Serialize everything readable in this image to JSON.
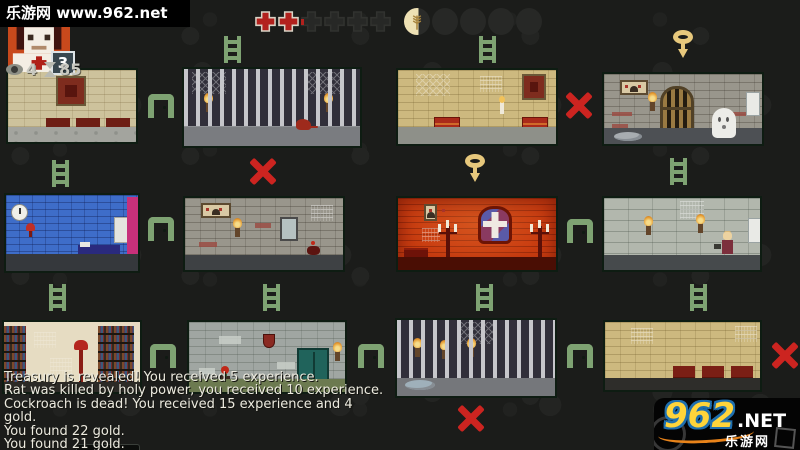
{
  "watermark": {
    "text": "乐游网 www.962.net"
  },
  "hud": {
    "portrait": {
      "badge": "3"
    },
    "stats": {
      "eye_value": "4",
      "hourglass_value": "85"
    },
    "health": {
      "full_crosses": 2,
      "partial_crosses": 1,
      "empty_crosses": 3
    },
    "food": {
      "partial_pips": 1,
      "partial_fill_percent": 55,
      "empty_pips": 4
    }
  },
  "map": {
    "rooms": [
      {
        "row": 1,
        "col": 1,
        "name": "chapel-with-pews"
      },
      {
        "row": 1,
        "col": 2,
        "name": "jail-cell-with-rat"
      },
      {
        "row": 1,
        "col": 3,
        "name": "hall-with-chests-and-candle"
      },
      {
        "row": 1,
        "col": 4,
        "name": "dungeon-gate-with-ghost"
      },
      {
        "row": 2,
        "col": 1,
        "name": "blue-bedroom"
      },
      {
        "row": 2,
        "col": 2,
        "name": "stone-hall-with-mirror"
      },
      {
        "row": 2,
        "col": 3,
        "name": "red-chapel-with-cross-window"
      },
      {
        "row": 2,
        "col": 4,
        "name": "stone-hall-with-hero"
      },
      {
        "row": 3,
        "col": 1,
        "name": "library"
      },
      {
        "row": 3,
        "col": 2,
        "name": "storage-with-cabinet-and-plant"
      },
      {
        "row": 3,
        "col": 3,
        "name": "jail-cell-with-torches"
      },
      {
        "row": 3,
        "col": 4,
        "name": "hall-with-benches"
      }
    ],
    "connectors": [
      {
        "type": "ladder",
        "x": 224,
        "y": 36
      },
      {
        "type": "ladder",
        "x": 479,
        "y": 36
      },
      {
        "type": "key",
        "x": 671,
        "y": 30
      },
      {
        "type": "arch",
        "x": 148,
        "y": 94
      },
      {
        "type": "x",
        "x": 564,
        "y": 90
      },
      {
        "type": "ladder",
        "x": 52,
        "y": 160
      },
      {
        "type": "x",
        "x": 248,
        "y": 156
      },
      {
        "type": "key",
        "x": 463,
        "y": 154
      },
      {
        "type": "ladder",
        "x": 670,
        "y": 158
      },
      {
        "type": "arch",
        "x": 148,
        "y": 217
      },
      {
        "type": "arch",
        "x": 567,
        "y": 219
      },
      {
        "type": "ladder",
        "x": 49,
        "y": 284
      },
      {
        "type": "ladder",
        "x": 263,
        "y": 284
      },
      {
        "type": "ladder",
        "x": 476,
        "y": 284
      },
      {
        "type": "ladder",
        "x": 690,
        "y": 284
      },
      {
        "type": "arch",
        "x": 150,
        "y": 344
      },
      {
        "type": "arch",
        "x": 358,
        "y": 344
      },
      {
        "type": "arch",
        "x": 567,
        "y": 344
      },
      {
        "type": "x",
        "x": 770,
        "y": 340
      },
      {
        "type": "x",
        "x": 456,
        "y": 403
      }
    ]
  },
  "log": {
    "lines": [
      "Treasury is revealed! You received 5 experience.",
      "Rat was killed by holy power, you received 10 experience.",
      "Cockroach is dead! You received 15 experience and 4",
      "gold.",
      "You found 22 gold.",
      "You found 21 gold."
    ]
  },
  "brand": {
    "number": "962",
    "tld": ".NET",
    "site": "乐游网"
  },
  "colors": {
    "path_green": "#7ea272",
    "blocked_red": "#cc2420",
    "key_yellow": "#e7c87c",
    "health_red": "#b2211d",
    "portrait_bg": "#c8491c"
  }
}
